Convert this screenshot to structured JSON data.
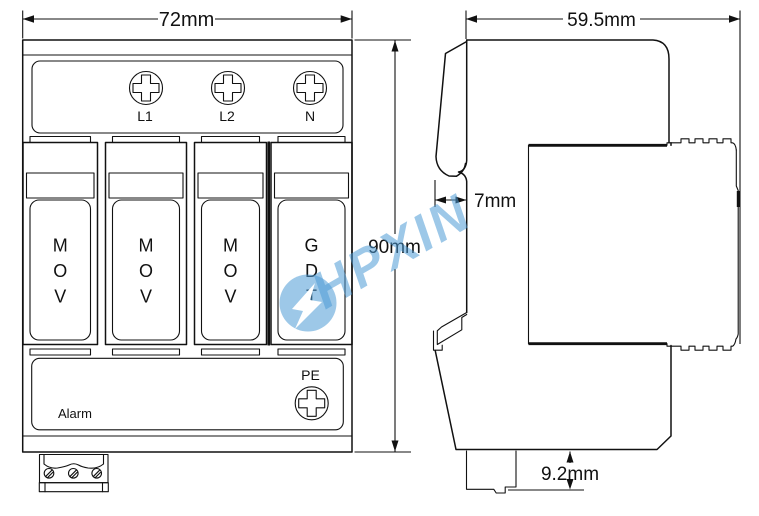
{
  "dims": {
    "front_width": "72mm",
    "front_height": "90mm",
    "side_depth": "59.5mm",
    "rail_flange": "7mm",
    "terminal_block": "9.2mm"
  },
  "front_view": {
    "terminals": [
      "L1",
      "L2",
      "N"
    ],
    "modules": [
      "MOV",
      "MOV",
      "MOV",
      "GDT"
    ],
    "pe_label": "PE",
    "alarm_label": "Alarm"
  },
  "watermark": {
    "brand": "HPXIN",
    "color": "#4d9bd5"
  },
  "colors": {
    "line": "#111111",
    "background": "#ffffff"
  }
}
